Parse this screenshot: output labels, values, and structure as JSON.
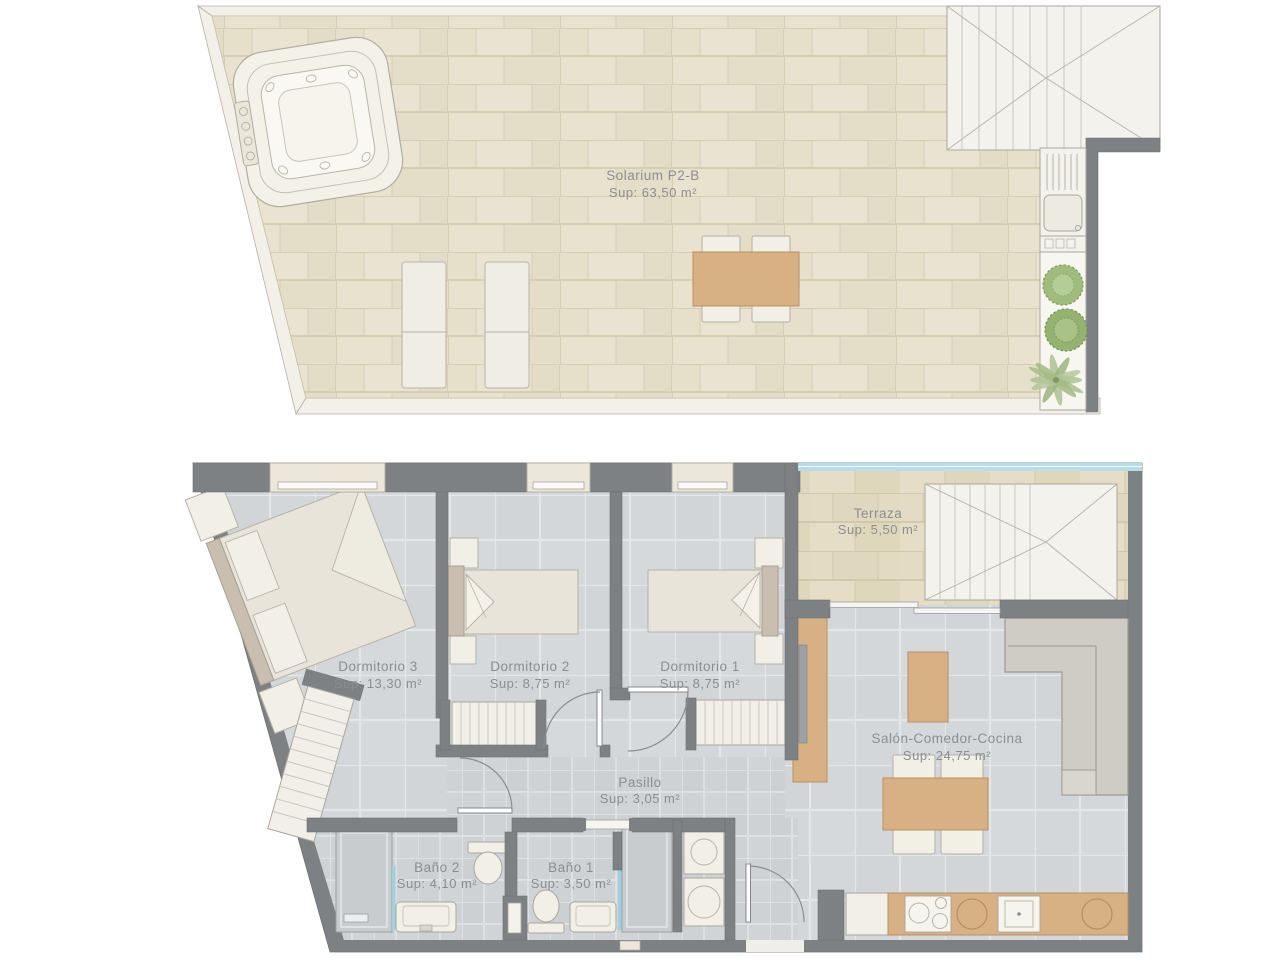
{
  "colors": {
    "wall": "#7e8184",
    "wood": "#d7b084",
    "solarium_tile": "#e7e0cc",
    "terrace_tile": "#e2dac2",
    "room_tile": "#d4d7da",
    "bath_tile": "#ced2d5",
    "label_text": "#8b8e90",
    "glass": "#b7dde9",
    "plant_green": "#9fbc7d",
    "sofa": "#cfccc3",
    "white_furniture": "#f2efe7"
  },
  "floor_plans": [
    {
      "id": "solarium",
      "label": {
        "name": "Solarium P2-B",
        "area": "Sup: 63,50 m²"
      }
    },
    {
      "id": "apartment",
      "rooms": [
        {
          "label": "Terraza",
          "area": "Sup: 5,50 m²"
        },
        {
          "label": "Dormitorio 3",
          "area": "Sup: 13,30 m²"
        },
        {
          "label": "Dormitorio 2",
          "area": "Sup: 8,75 m²"
        },
        {
          "label": "Dormitorio 1",
          "area": "Sup: 8,75 m²"
        },
        {
          "label": "Salón-Comedor-Cocina",
          "area": "Sup: 24,75 m²"
        },
        {
          "label": "Pasillo",
          "area": "Sup: 3,05 m²"
        },
        {
          "label": "Baño 2",
          "area": "Sup: 4,10 m²"
        },
        {
          "label": "Baño 1",
          "area": "Sup: 3,50 m²"
        }
      ]
    }
  ]
}
